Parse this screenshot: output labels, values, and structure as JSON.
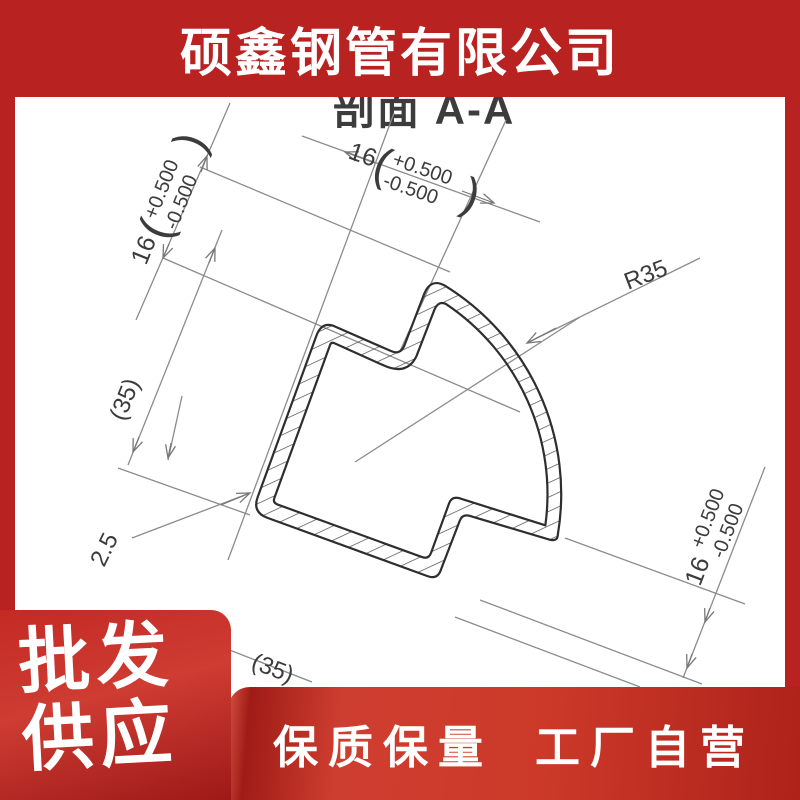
{
  "header": {
    "company_name": "硕鑫钢管有限公司"
  },
  "drawing": {
    "title": "剖面 A-A",
    "dim_top": {
      "value": "16",
      "paren_open": "(",
      "tol_plus": "+0.500",
      "tol_minus": "-0.500",
      "paren_close": ")"
    },
    "dim_left": {
      "value": "16",
      "paren_open": "(",
      "tol_plus": "+0.500",
      "tol_minus": "-0.500",
      "paren_close": ")"
    },
    "dim_right": {
      "value": "16",
      "tol_plus": "+0.500",
      "tol_minus": "-0.500"
    },
    "dim_height": "(35)",
    "dim_width": "(35)",
    "wall_thickness": "2.5",
    "radius": "R35"
  },
  "promo": {
    "line1": "批发",
    "line2": "供应"
  },
  "banner": {
    "left": "保质保量",
    "right": "工厂自营"
  },
  "colors": {
    "frame_red": "#b82220",
    "panel_red": "#c32a24",
    "banner_red": "#cc3929",
    "line_gray": "#8b8b8b",
    "profile_ink": "#2e2e2e"
  }
}
